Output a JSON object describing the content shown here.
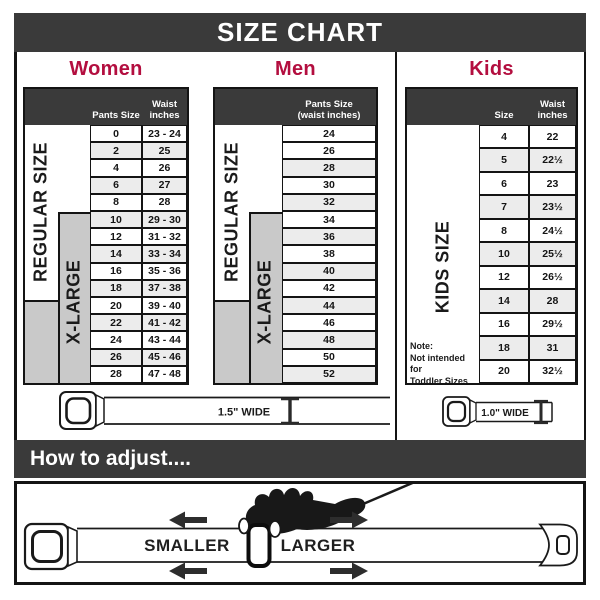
{
  "title": "SIZE CHART",
  "colors": {
    "bar_dark": "#3a3a3a",
    "heading_red": "#b30e3f",
    "band_gray": "#c9c9c9",
    "row_tint": "#ececec"
  },
  "sections": {
    "women": {
      "heading": "Women",
      "header": {
        "pants": "Pants Size",
        "waist1": "Waist",
        "waist2": "inches"
      },
      "bands": {
        "regular": "REGULAR SIZE",
        "xlarge": "X-LARGE"
      },
      "rows": [
        {
          "size": "0",
          "waist": "23 - 24"
        },
        {
          "size": "2",
          "waist": "25"
        },
        {
          "size": "4",
          "waist": "26"
        },
        {
          "size": "6",
          "waist": "27"
        },
        {
          "size": "8",
          "waist": "28"
        },
        {
          "size": "10",
          "waist": "29 - 30"
        },
        {
          "size": "12",
          "waist": "31 - 32"
        },
        {
          "size": "14",
          "waist": "33 - 34"
        },
        {
          "size": "16",
          "waist": "35 - 36"
        },
        {
          "size": "18",
          "waist": "37 - 38"
        },
        {
          "size": "20",
          "waist": "39 - 40"
        },
        {
          "size": "22",
          "waist": "41 - 42"
        },
        {
          "size": "24",
          "waist": "43 - 44"
        },
        {
          "size": "26",
          "waist": "45 - 46"
        },
        {
          "size": "28",
          "waist": "47 - 48"
        }
      ]
    },
    "men": {
      "heading": "Men",
      "header": {
        "line1": "Pants Size",
        "line2": "(waist inches)"
      },
      "bands": {
        "regular": "REGULAR SIZE",
        "xlarge": "X-LARGE"
      },
      "rows": [
        "24",
        "26",
        "28",
        "30",
        "32",
        "34",
        "36",
        "38",
        "40",
        "42",
        "44",
        "46",
        "48",
        "50",
        "52"
      ]
    },
    "kids": {
      "heading": "Kids",
      "header": {
        "size": "Size",
        "waist1": "Waist",
        "waist2": "inches"
      },
      "band": "KIDS SIZE",
      "note": {
        "line1": "Note:",
        "line2": "Not intended for",
        "line3": "Toddler Sizes (T)"
      },
      "rows": [
        {
          "size": "4",
          "waist": "22"
        },
        {
          "size": "5",
          "waist": "22½"
        },
        {
          "size": "6",
          "waist": "23"
        },
        {
          "size": "7",
          "waist": "23½"
        },
        {
          "size": "8",
          "waist": "24½"
        },
        {
          "size": "10",
          "waist": "25½"
        },
        {
          "size": "12",
          "waist": "26½"
        },
        {
          "size": "14",
          "waist": "28"
        },
        {
          "size": "16",
          "waist": "29½"
        },
        {
          "size": "18",
          "waist": "31"
        },
        {
          "size": "20",
          "waist": "32½"
        }
      ]
    }
  },
  "belts": {
    "adult_width_label": "1.5\" WIDE",
    "kids_width_label": "1.0\" WIDE"
  },
  "adjust": {
    "heading": "How to adjust....",
    "smaller": "SMALLER",
    "larger": "LARGER"
  }
}
